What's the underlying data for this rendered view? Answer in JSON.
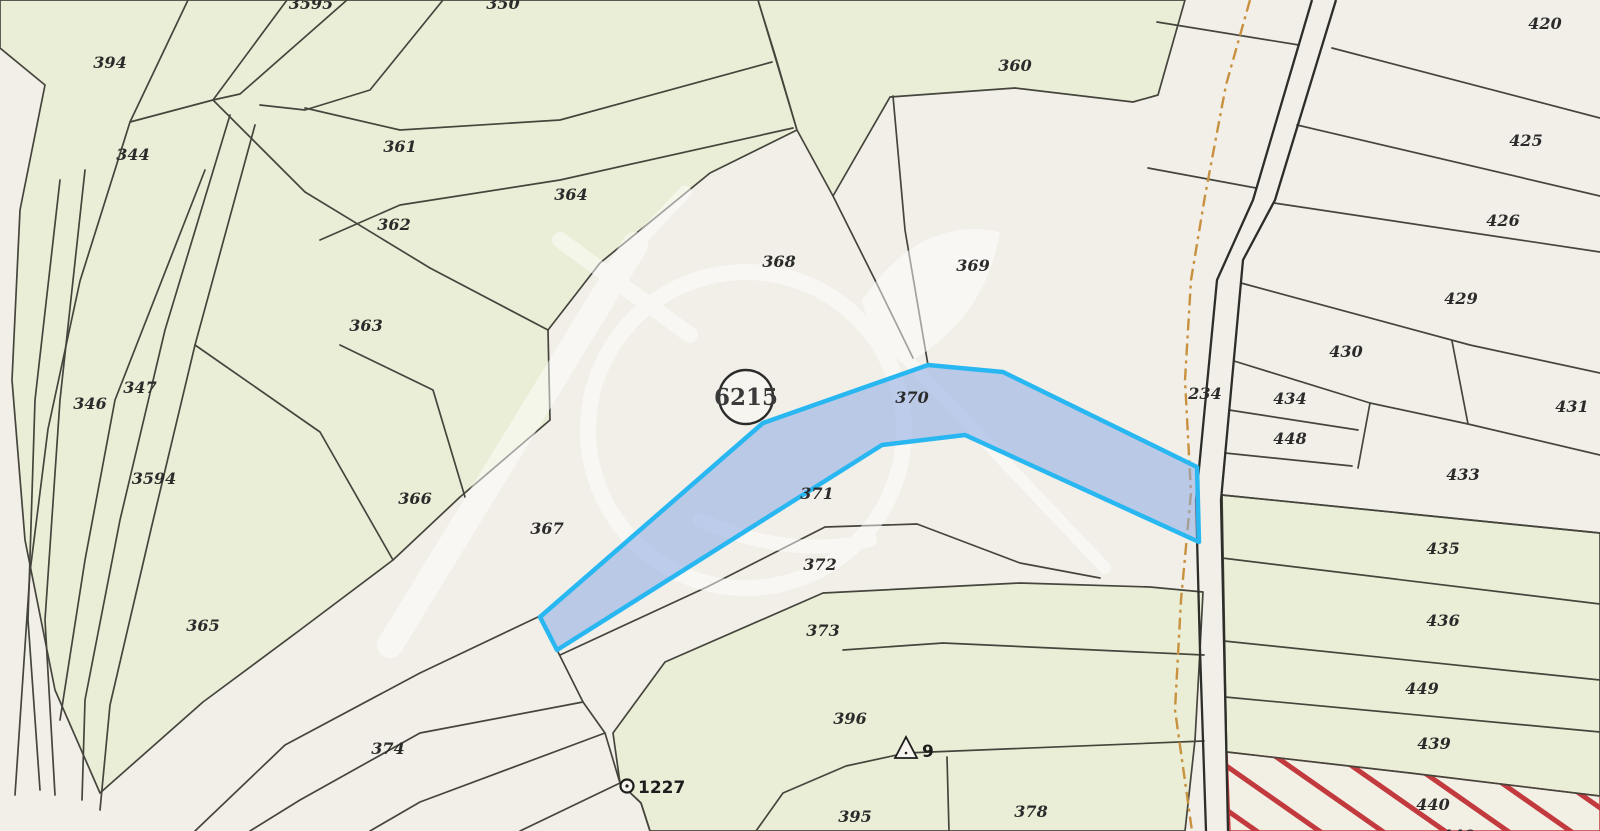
{
  "map": {
    "type": "cadastral-parcel-map",
    "highlighted_parcel": {
      "label": "370",
      "badge": "6215"
    },
    "road_parcel": "234",
    "hatched_parcel": "440",
    "survey_point": {
      "label": "1227"
    },
    "triangulation_point": {
      "label": "9"
    },
    "colors": {
      "background": "#f2efe8",
      "parcel_green": "#ebeed6",
      "boundary": "#45453d",
      "road": "#2d2d29",
      "trail": "#c8913f",
      "highlight_fill": "#9fc0e8",
      "highlight_stroke": "#29b7f2",
      "hatch_red": "#c23a3e",
      "label_color": "#2b2b2b",
      "watermark": "#ffffff"
    },
    "labels": [
      {
        "text": "394",
        "x": 110,
        "y": 68
      },
      {
        "text": "344",
        "x": 133,
        "y": 160
      },
      {
        "text": "3595",
        "x": 311,
        "y": 9
      },
      {
        "text": "350",
        "x": 503,
        "y": 9
      },
      {
        "text": "361",
        "x": 400,
        "y": 152
      },
      {
        "text": "362",
        "x": 394,
        "y": 230
      },
      {
        "text": "364",
        "x": 571,
        "y": 200
      },
      {
        "text": "363",
        "x": 366,
        "y": 331
      },
      {
        "text": "346",
        "x": 90,
        "y": 409
      },
      {
        "text": "347",
        "x": 140,
        "y": 393
      },
      {
        "text": "3594",
        "x": 154,
        "y": 484
      },
      {
        "text": "366",
        "x": 415,
        "y": 504
      },
      {
        "text": "365",
        "x": 203,
        "y": 631
      },
      {
        "text": "367",
        "x": 547,
        "y": 534
      },
      {
        "text": "374",
        "x": 388,
        "y": 754
      },
      {
        "text": "368",
        "x": 779,
        "y": 267
      },
      {
        "text": "369",
        "x": 973,
        "y": 271
      },
      {
        "text": "360",
        "x": 1015,
        "y": 71
      },
      {
        "text": "370",
        "x": 912,
        "y": 403
      },
      {
        "text": "371",
        "x": 817,
        "y": 499
      },
      {
        "text": "372",
        "x": 820,
        "y": 570
      },
      {
        "text": "373",
        "x": 823,
        "y": 636
      },
      {
        "text": "396",
        "x": 850,
        "y": 724
      },
      {
        "text": "395",
        "x": 855,
        "y": 822
      },
      {
        "text": "378",
        "x": 1031,
        "y": 817
      },
      {
        "text": "420",
        "x": 1545,
        "y": 29
      },
      {
        "text": "425",
        "x": 1526,
        "y": 146
      },
      {
        "text": "426",
        "x": 1503,
        "y": 226
      },
      {
        "text": "429",
        "x": 1461,
        "y": 304
      },
      {
        "text": "430",
        "x": 1346,
        "y": 357
      },
      {
        "text": "431",
        "x": 1572,
        "y": 412
      },
      {
        "text": "434",
        "x": 1290,
        "y": 404
      },
      {
        "text": "448",
        "x": 1290,
        "y": 444
      },
      {
        "text": "433",
        "x": 1463,
        "y": 480
      },
      {
        "text": "234",
        "x": 1205,
        "y": 399
      },
      {
        "text": "435",
        "x": 1443,
        "y": 554
      },
      {
        "text": "436",
        "x": 1443,
        "y": 626
      },
      {
        "text": "449",
        "x": 1422,
        "y": 694
      },
      {
        "text": "439",
        "x": 1434,
        "y": 749
      },
      {
        "text": "440",
        "x": 1433,
        "y": 810
      },
      {
        "text": "440",
        "x": 1458,
        "y": 841
      },
      {
        "text": "6215",
        "x": 746,
        "y": 405,
        "cls": "lbl-big"
      },
      {
        "text": "1227",
        "x": 638,
        "y": 793,
        "cls": "lbl-pt"
      },
      {
        "text": "9",
        "x": 922,
        "y": 757,
        "cls": "lbl-pt"
      }
    ]
  }
}
